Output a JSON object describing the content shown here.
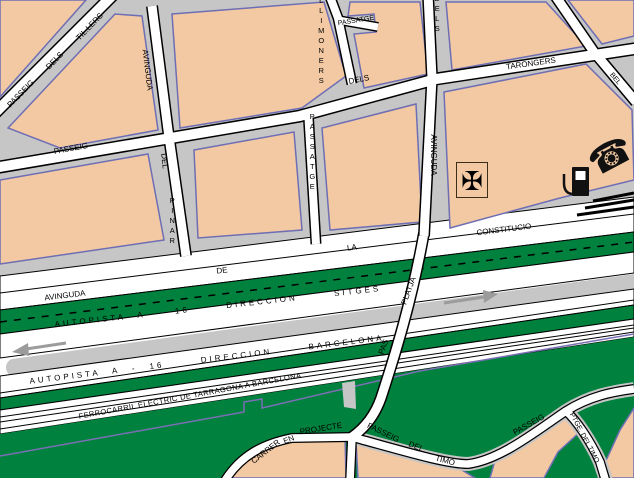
{
  "map": {
    "colors": {
      "block_tan": "#F2C9A3",
      "green": "#00813D",
      "road_gray": "#C6C6C6",
      "street_white": "#FFFFFF",
      "line_black": "#000000",
      "arrow_gray": "#9C9C9C",
      "rail_purple": "#7A6FB5",
      "block_outline": "#6E6EB4"
    },
    "icons": {
      "cross_glyph": "✠",
      "phone_glyph": "☎",
      "fuel_pump": "fuel-pump-symbol"
    },
    "arrows": [
      {
        "id": "westbound",
        "direction": "left"
      },
      {
        "id": "eastbound",
        "direction": "right"
      }
    ],
    "labels": [
      {
        "id": "passeig-tillers-1",
        "text": "PASSEIG",
        "x": 21,
        "y": 94,
        "r": -46
      },
      {
        "id": "passeig-tillers-2",
        "text": "DELS",
        "x": 55,
        "y": 61,
        "r": -46
      },
      {
        "id": "passeig-tillers-3",
        "text": "TIL.LERS",
        "x": 90,
        "y": 27,
        "r": -46
      },
      {
        "id": "avinguda-pinar-1",
        "text": "AVINGUDA",
        "x": 147,
        "y": 70,
        "r": 83
      },
      {
        "id": "avinguda-pinar-2",
        "text": "DEL",
        "x": 164,
        "y": 161,
        "r": 84
      },
      {
        "id": "avinguda-pinar-3",
        "text": "PINAR",
        "x": 172,
        "y": 221,
        "r": 0,
        "mode": "v"
      },
      {
        "id": "passeig-left",
        "text": "PASSEIG",
        "x": 71,
        "y": 149,
        "r": -10
      },
      {
        "id": "dels-mid",
        "text": "DELS",
        "x": 359,
        "y": 80,
        "r": -11
      },
      {
        "id": "tarongers",
        "text": "TARONGERS",
        "x": 531,
        "y": 64,
        "r": -8
      },
      {
        "id": "llimoners",
        "text": "LLIMONERS",
        "x": 321,
        "y": 41,
        "r": 0,
        "mode": "v"
      },
      {
        "id": "passatge-stub",
        "text": "PASSATGE",
        "x": 356,
        "y": 21,
        "r": -9,
        "fs": 7
      },
      {
        "id": "passatge-vertical",
        "text": "PASSATGE",
        "x": 312,
        "y": 152,
        "r": 0,
        "mode": "v"
      },
      {
        "id": "dels-top",
        "text": "DELS",
        "x": 437,
        "y": 14,
        "r": 0,
        "mode": "v"
      },
      {
        "id": "avinguda-vertical",
        "text": "AVINGUDA",
        "x": 433,
        "y": 155,
        "r": 90
      },
      {
        "id": "street-partial-right",
        "text": "BEL",
        "x": 615,
        "y": 79,
        "r": 50,
        "fs": 7
      },
      {
        "id": "avenue-1",
        "text": "AVINGUDA",
        "x": 65,
        "y": 296,
        "r": -7
      },
      {
        "id": "avenue-2",
        "text": "DE",
        "x": 222,
        "y": 271,
        "r": -7
      },
      {
        "id": "avenue-3",
        "text": "LA",
        "x": 352,
        "y": 248,
        "r": -7
      },
      {
        "id": "avenue-4",
        "text": "CONSTITUCIO",
        "x": 504,
        "y": 230,
        "r": -7
      },
      {
        "id": "autopista-sitges",
        "text": "AUTOPISTA A - 16   DIRECCION   SITGES",
        "x": 218,
        "y": 307,
        "r": -6.3,
        "cls": "hwy"
      },
      {
        "id": "autopista-barcelona",
        "text": "AUTOPISTA A - 16   DIRECCION   BARCELONA",
        "x": 207,
        "y": 360,
        "r": -7,
        "cls": "hwy"
      },
      {
        "id": "ferrocarril",
        "text": "FERROCARRIL ELECTRIC DE TARRAGONA A BARCELONA",
        "x": 190,
        "y": 396,
        "r": -10.5,
        "cls": "rail"
      },
      {
        "id": "carrer",
        "text": "CARRER",
        "x": 266,
        "y": 452,
        "r": -38
      },
      {
        "id": "en",
        "text": "EN",
        "x": 289,
        "y": 440,
        "r": -22
      },
      {
        "id": "projecte",
        "text": "PROJECTE",
        "x": 321,
        "y": 429,
        "r": -9
      },
      {
        "id": "passeig-timo-1",
        "text": "PASSEIG",
        "x": 383,
        "y": 433,
        "r": 26
      },
      {
        "id": "passeig-timo-2",
        "text": "DEL",
        "x": 416,
        "y": 447,
        "r": 22
      },
      {
        "id": "passeig-timo-3",
        "text": "TIMO",
        "x": 445,
        "y": 461,
        "r": 15
      },
      {
        "id": "passeig-right",
        "text": "PASSEIG",
        "x": 529,
        "y": 425,
        "r": -29
      },
      {
        "id": "ptge-del-timo",
        "text": "PTGE. DEL TIMO",
        "x": 584,
        "y": 438,
        "r": 62,
        "fs": 7
      },
      {
        "id": "pas",
        "text": "PAS",
        "x": 384,
        "y": 347,
        "r": -70
      },
      {
        "id": "platja",
        "text": "PLATJA",
        "x": 409,
        "y": 291,
        "r": -70
      }
    ]
  }
}
